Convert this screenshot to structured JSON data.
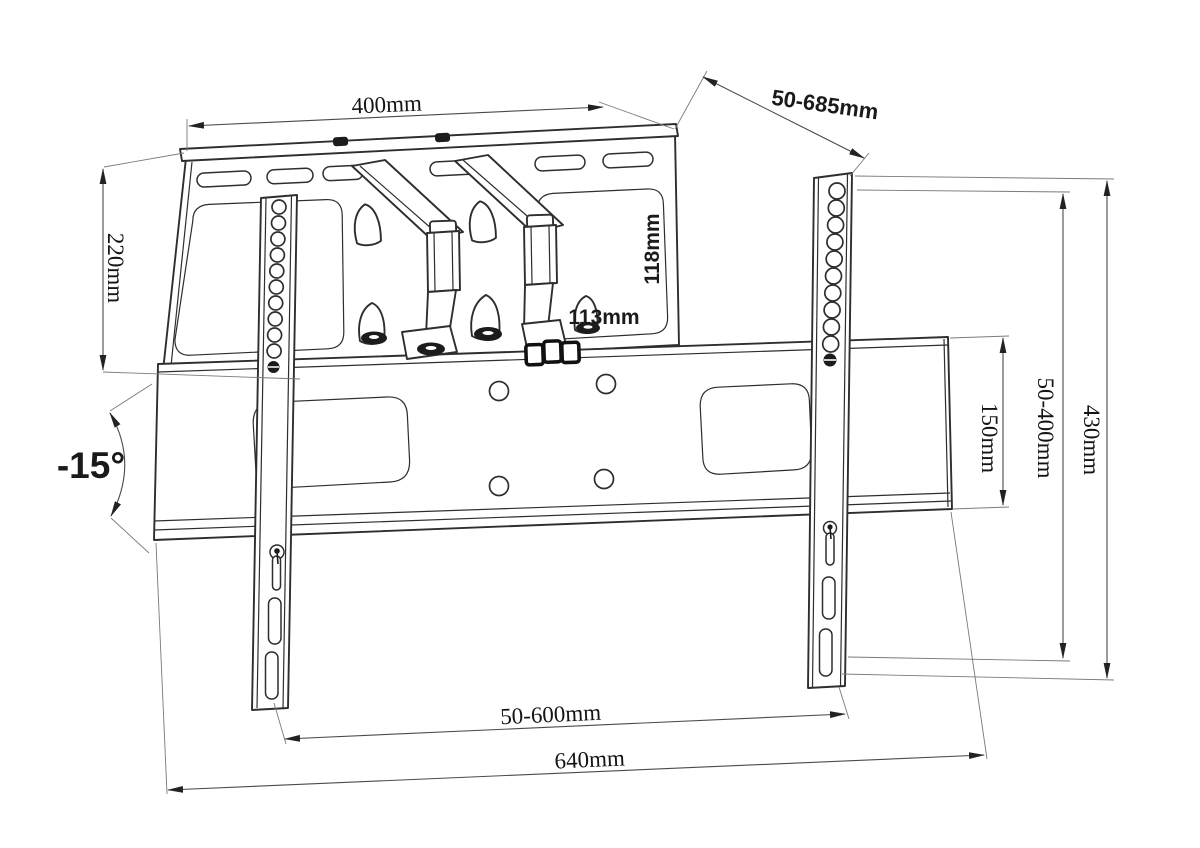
{
  "page": {
    "background": "#ffffff"
  },
  "drawing": {
    "subject": "Full-motion TV wall mount bracket, dimensioned line drawing",
    "line_color": "#2e2e2e",
    "dim_line_color": "#4a4a4a",
    "labels": {
      "plate_width": "400mm",
      "extension_range": "50-685mm",
      "plate_height": "220mm",
      "arm_clearance_height": "118mm",
      "arm_clearance_width": "113mm",
      "rail_height": "150mm",
      "vesa_vertical_range": "50-400mm",
      "tv_bracket_height": "430mm",
      "vesa_horizontal_range": "50-600mm",
      "rail_width": "640mm",
      "tilt_angle": "-15°"
    }
  }
}
